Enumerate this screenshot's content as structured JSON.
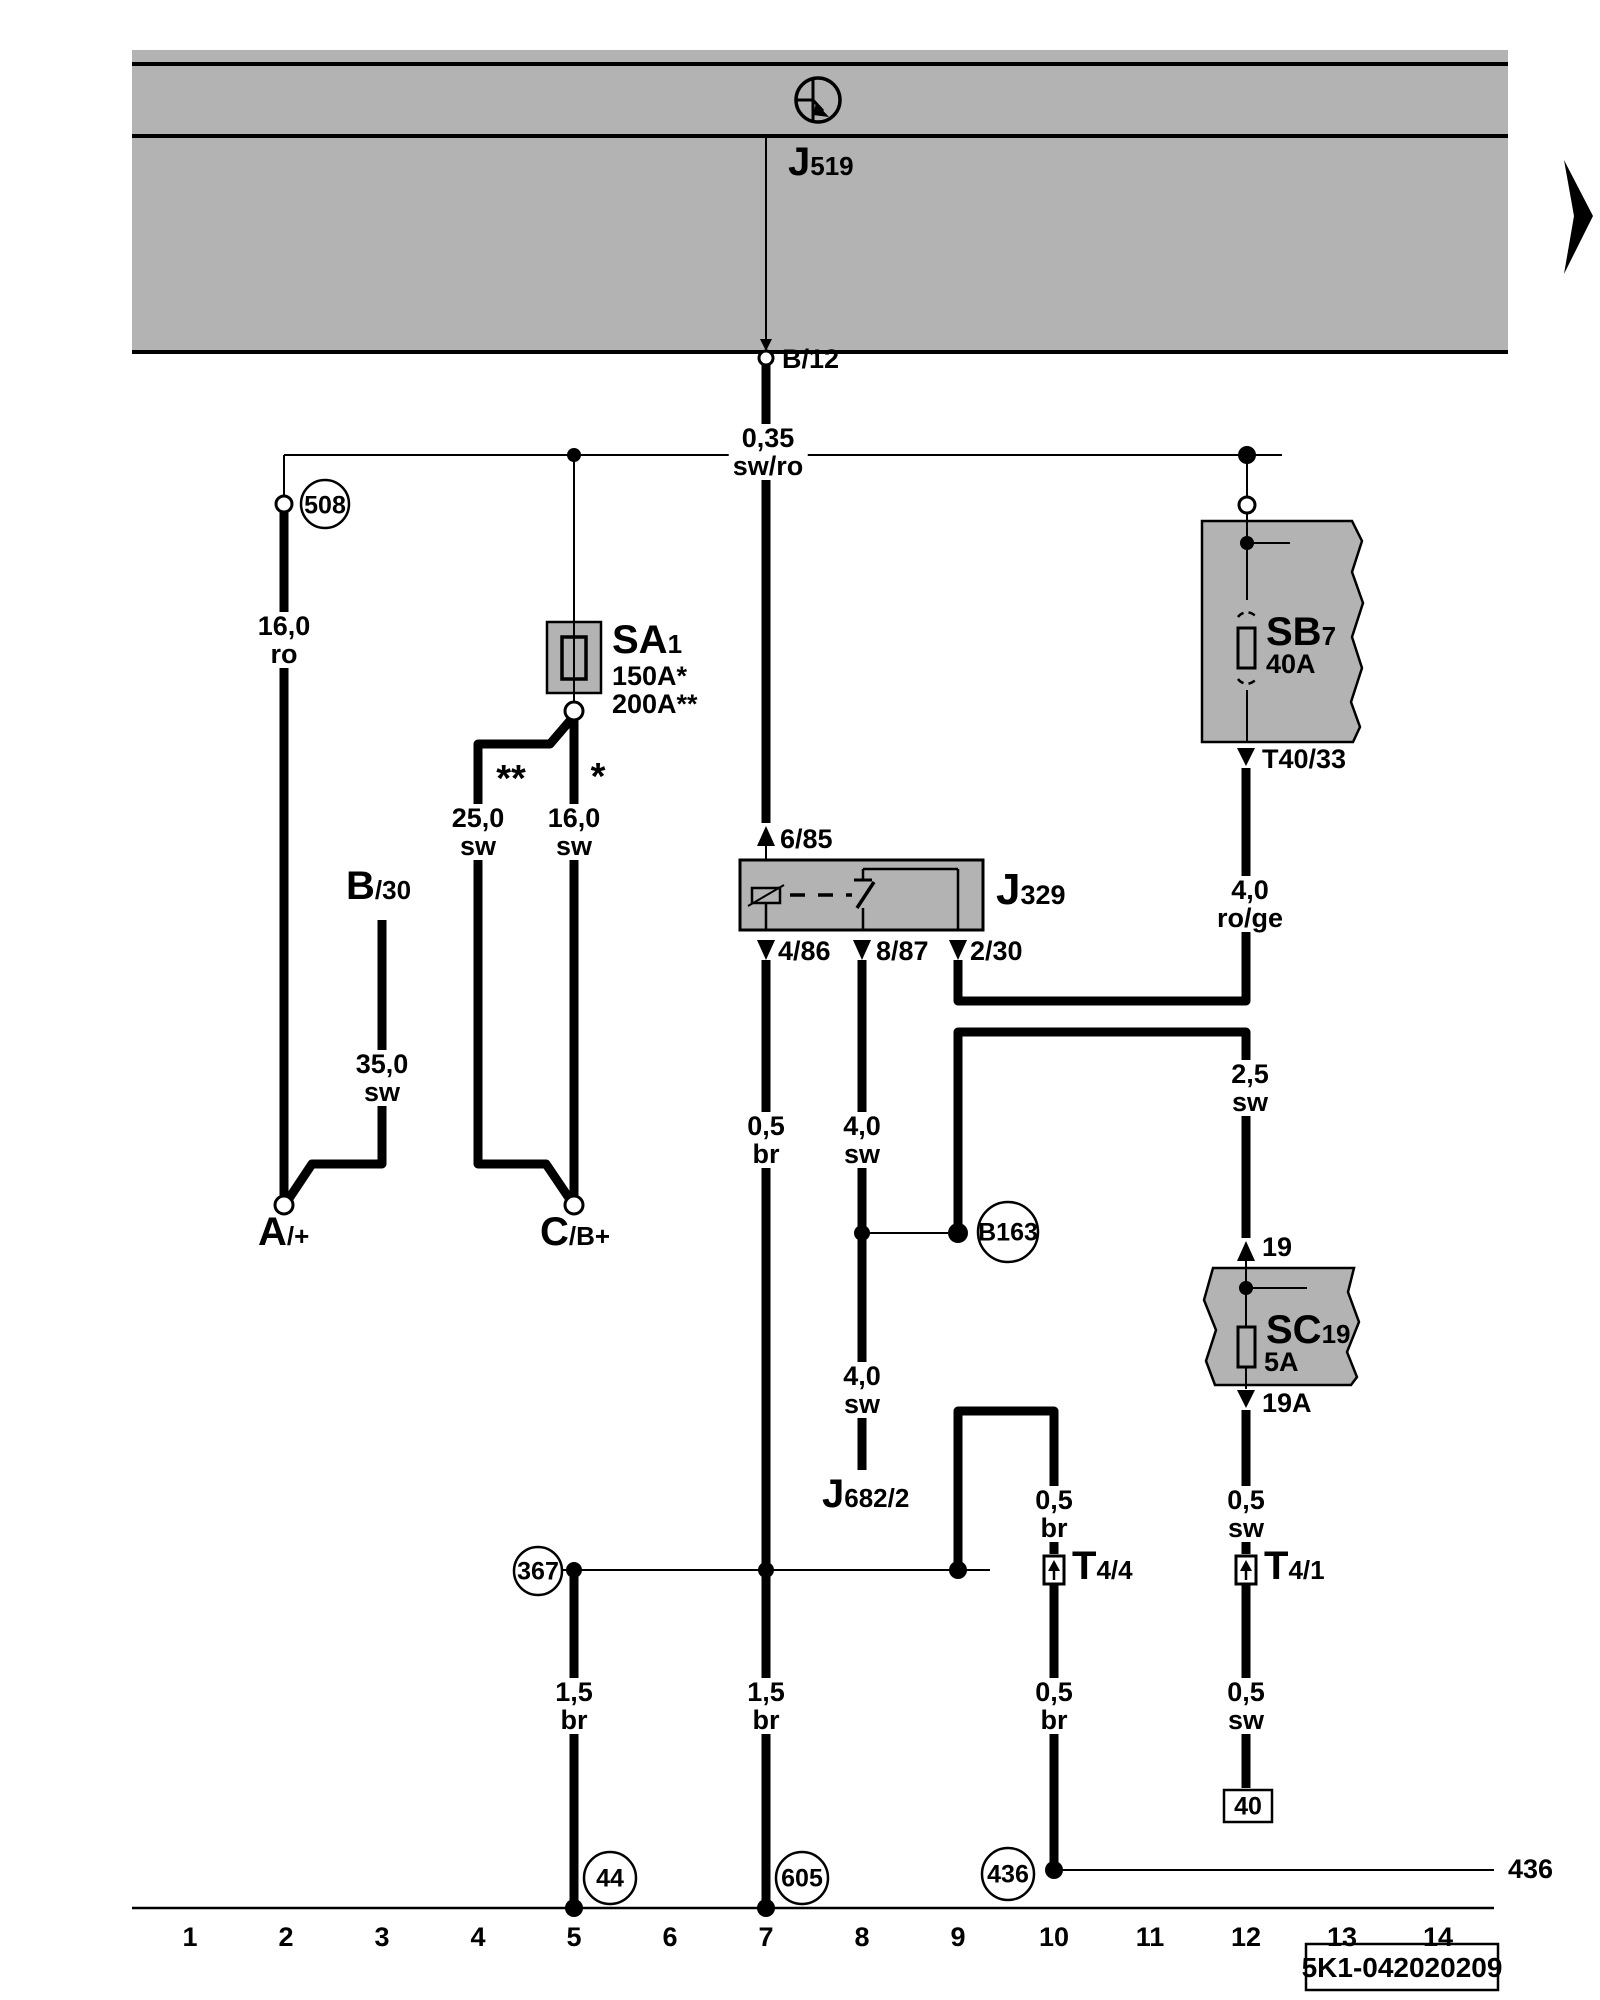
{
  "diagram": {
    "top_module": {
      "prefix": "J",
      "sub": "519",
      "terminal": "B/12",
      "symbol": "battery-positive-terminal"
    },
    "page_code": "5K1-042020209",
    "right_continuation": "436",
    "grid": [
      "1",
      "2",
      "3",
      "4",
      "5",
      "6",
      "7",
      "8",
      "9",
      "10",
      "11",
      "12",
      "13",
      "14"
    ],
    "components": {
      "sa1": {
        "prefix": "SA",
        "sub": "1",
        "rating_single": "150A*",
        "rating_double": "200A**"
      },
      "j329": {
        "prefix": "J",
        "sub": "329",
        "terminals": {
          "t85": "6/85",
          "t86": "4/86",
          "t87": "8/87",
          "t30": "2/30"
        }
      },
      "sb7": {
        "prefix": "SB",
        "sub": "7",
        "rating": "40A",
        "terminal": "T40/33"
      },
      "sc19": {
        "prefix": "SC",
        "sub": "19",
        "rating": "5A",
        "terminal_in": "19",
        "terminal_out": "19A"
      },
      "t4_4": {
        "prefix": "T",
        "sub": "4/4"
      },
      "t4_1": {
        "prefix": "T",
        "sub": "4/1"
      },
      "j682": {
        "prefix": "J",
        "sub": "682/2"
      },
      "battery_a": {
        "prefix": "A",
        "sub": "/+"
      },
      "battery_c": {
        "prefix": "C",
        "sub": "/B+"
      },
      "b30": {
        "prefix": "B",
        "sub": "/30"
      }
    },
    "nodes": {
      "n508": "508",
      "n367": "367",
      "n44": "44",
      "n605": "605",
      "n436": "436",
      "b163": "B163",
      "box40": "40"
    },
    "stars": {
      "single": "*",
      "double": "**"
    },
    "wire_labels": {
      "w035": {
        "size": "0,35",
        "color": "sw/ro"
      },
      "w16ro": {
        "size": "16,0",
        "color": "ro"
      },
      "w25sw": {
        "size": "25,0",
        "color": "sw"
      },
      "w16sw": {
        "size": "16,0",
        "color": "sw"
      },
      "w35sw": {
        "size": "35,0",
        "color": "sw"
      },
      "w05br_a": {
        "size": "0,5",
        "color": "br"
      },
      "w40sw_a": {
        "size": "4,0",
        "color": "sw"
      },
      "w40roge": {
        "size": "4,0",
        "color": "ro/ge"
      },
      "w25sw2": {
        "size": "2,5",
        "color": "sw"
      },
      "w40sw_b": {
        "size": "4,0",
        "color": "sw"
      },
      "w05br_b": {
        "size": "0,5",
        "color": "br"
      },
      "w05sw_a": {
        "size": "0,5",
        "color": "sw"
      },
      "w15br_a": {
        "size": "1,5",
        "color": "br"
      },
      "w15br_b": {
        "size": "1,5",
        "color": "br"
      },
      "w05br_c": {
        "size": "0,5",
        "color": "br"
      },
      "w05sw_b": {
        "size": "0,5",
        "color": "sw"
      }
    }
  }
}
